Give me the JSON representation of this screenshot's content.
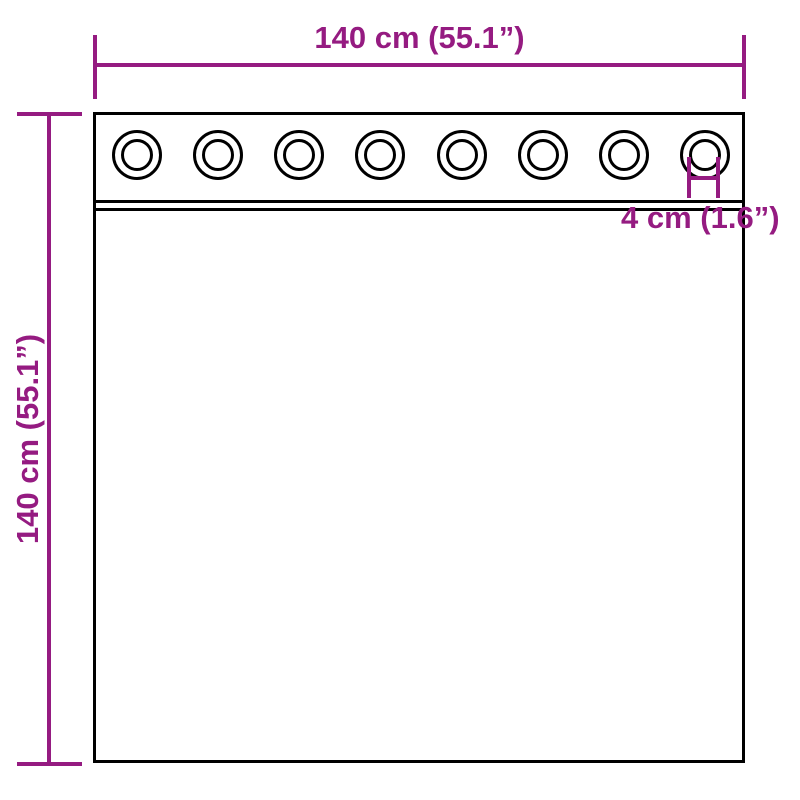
{
  "diagram": {
    "accent_color": "#951B81",
    "outline_color": "#000000",
    "background_color": "#FFFFFF",
    "width_dimension_label": "140 cm (55.1”)",
    "height_dimension_label": "140 cm (55.1”)",
    "grommet_dimension_label": "4 cm (1.6”)",
    "grommet_count": 8
  }
}
